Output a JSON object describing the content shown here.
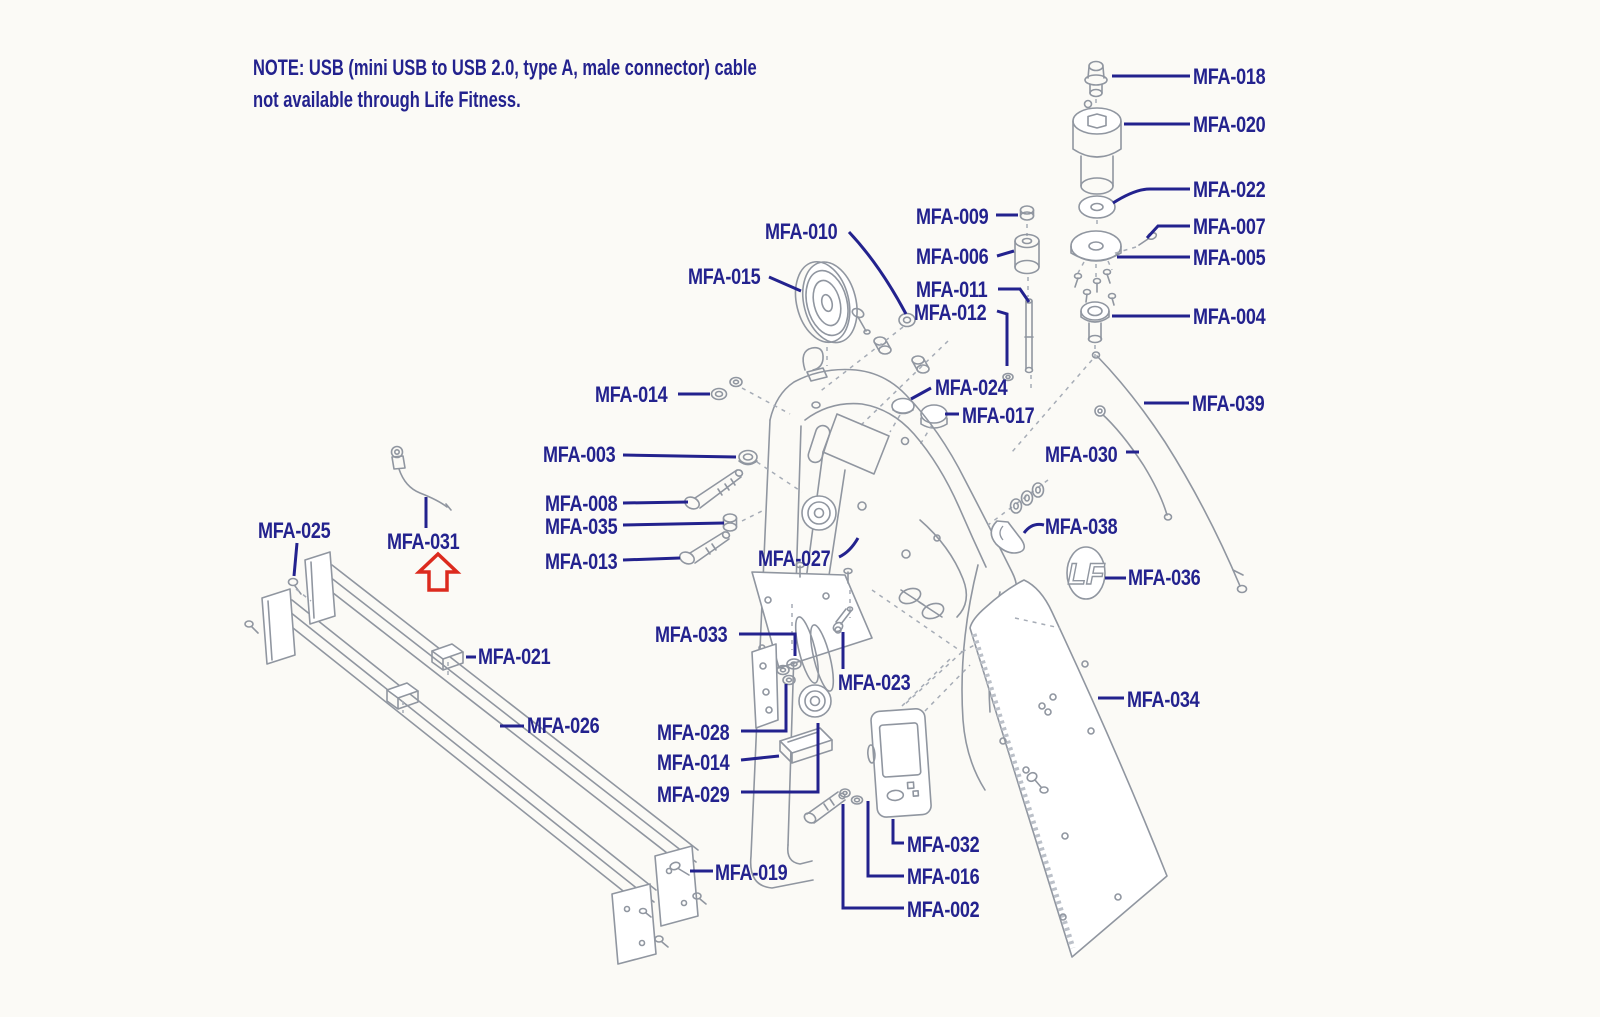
{
  "note": {
    "line1": "NOTE: USB (mini USB to USB 2.0, type A, male connector) cable",
    "line2": "not available through Life Fitness."
  },
  "badge_text": "LF",
  "icons": {
    "red_arrow": "red-up-arrow-highlight",
    "badge": "life-fitness-lf-logo"
  },
  "colors": {
    "label_text": "#23228e",
    "leader_line": "#23228e",
    "line_art": "#9096a0",
    "highlight_arrow": "#dc2a1e",
    "background": "#fbfaf6"
  },
  "labels": {
    "mfa002": "MFA-002",
    "mfa003": "MFA-003",
    "mfa004": "MFA-004",
    "mfa005": "MFA-005",
    "mfa006": "MFA-006",
    "mfa007": "MFA-007",
    "mfa008": "MFA-008",
    "mfa009": "MFA-009",
    "mfa010": "MFA-010",
    "mfa011": "MFA-011",
    "mfa012": "MFA-012",
    "mfa013": "MFA-013",
    "mfa014": "MFA-014",
    "mfa015": "MFA-015",
    "mfa016": "MFA-016",
    "mfa017": "MFA-017",
    "mfa018": "MFA-018",
    "mfa019": "MFA-019",
    "mfa020": "MFA-020",
    "mfa021": "MFA-021",
    "mfa022": "MFA-022",
    "mfa023": "MFA-023",
    "mfa024": "MFA-024",
    "mfa025": "MFA-025",
    "mfa026": "MFA-026",
    "mfa027": "MFA-027",
    "mfa028": "MFA-028",
    "mfa029": "MFA-029",
    "mfa030": "MFA-030",
    "mfa031": "MFA-031",
    "mfa032": "MFA-032",
    "mfa033": "MFA-033",
    "mfa034": "MFA-034",
    "mfa035": "MFA-035",
    "mfa036": "MFA-036",
    "mfa038": "MFA-038",
    "mfa039": "MFA-039"
  }
}
